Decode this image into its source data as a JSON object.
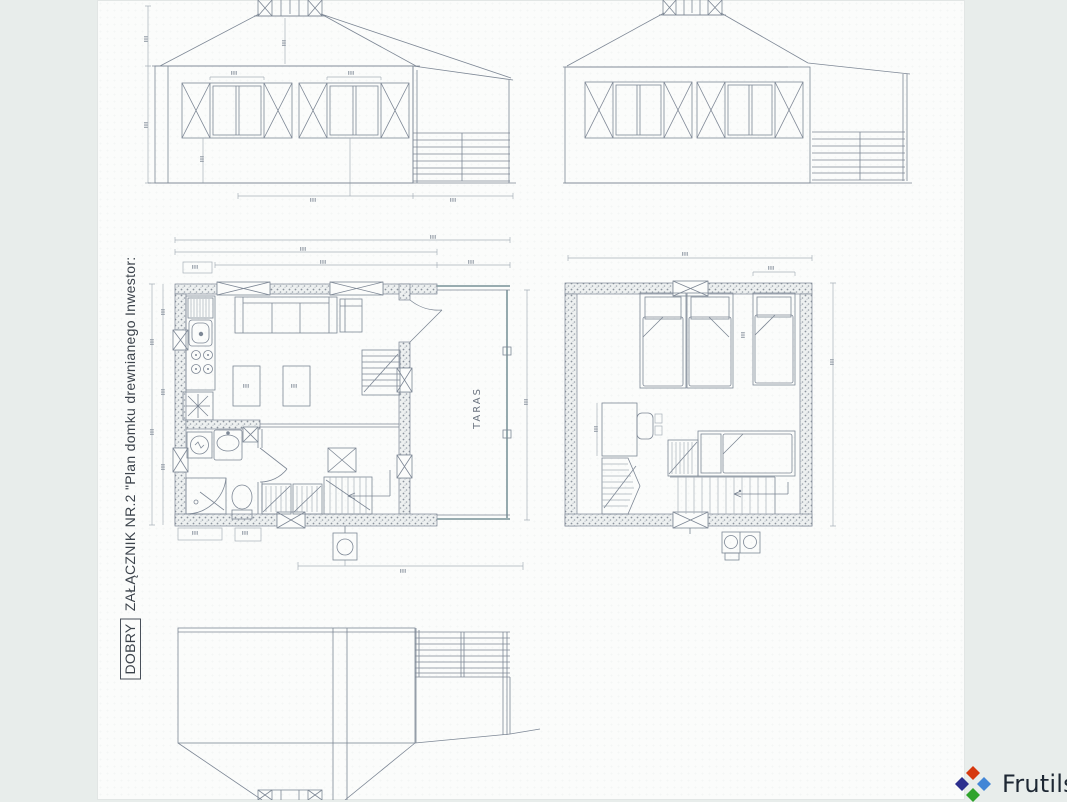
{
  "stamp": {
    "boxed_word": "DOBRY",
    "annotation": "ZAŁĄCZNIK NR.2 \"Plan domku drewnianego Inwestor:"
  },
  "floor_plan": {
    "terrace_label": "TARAS"
  },
  "logo": {
    "brand": "Frutils",
    "text_color": "#1d2733",
    "diamond_colors": {
      "top": "#d6380e",
      "left": "#2c2f8e",
      "right": "#4286d6",
      "bottom": "#2fa32c"
    }
  },
  "colors": {
    "side_bar": "#e8edeb",
    "scan_background": "#fbfcfb",
    "drawing_line": "#7d8795",
    "terrace_edge": "#8aa0a6",
    "stamp_text": "#3c434b"
  }
}
